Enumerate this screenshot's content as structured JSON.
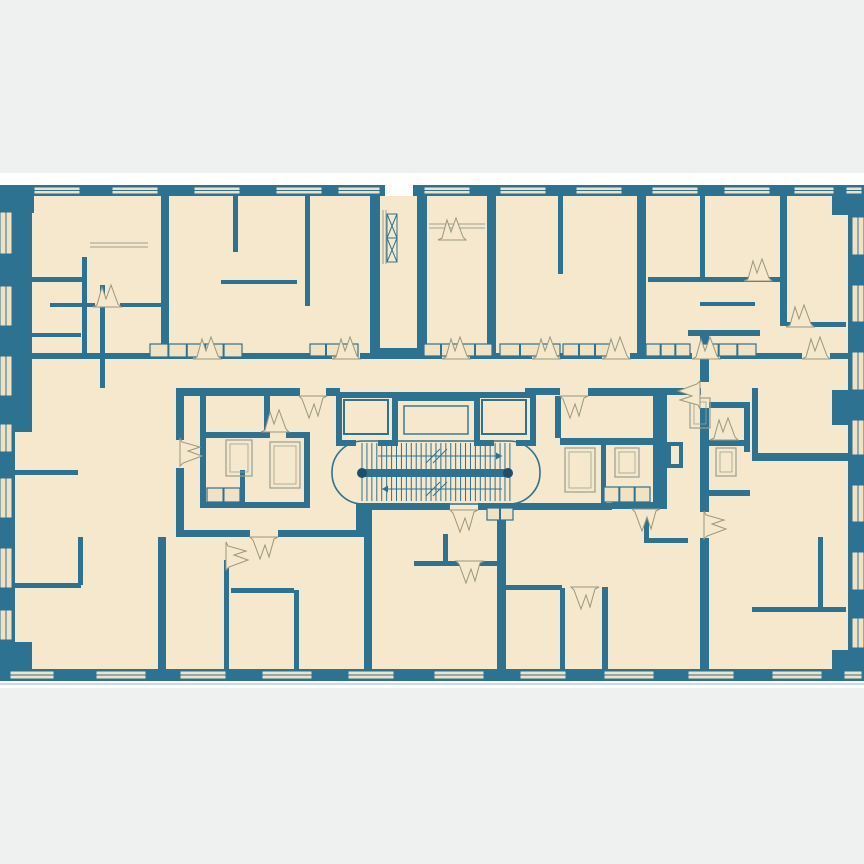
{
  "meta": {
    "title": "apartment-building-floor-plan",
    "canvas_w": 864,
    "canvas_h": 864
  },
  "palette": {
    "teal": "#2E7291",
    "teal_dark": "#1C4F6B",
    "beige": "#F6E8CC",
    "window_beige": "#F0E2C2",
    "gray_bg": "#EFF1F1",
    "white": "#FFFFFF",
    "door_stroke": "#98977F",
    "fixture_stroke": "#6E93A6",
    "furn_gray": "#9AA092",
    "light_line": "#C9DDE8"
  },
  "background": {
    "gray_top": [
      0,
      0,
      864,
      173
    ],
    "gray_bottom": [
      0,
      688,
      864,
      176
    ],
    "light_line_y": 684,
    "plan_base": [
      0,
      196,
      864,
      473
    ]
  },
  "outer_walls": [
    [
      0,
      185,
      385,
      11
    ],
    [
      413,
      185,
      451,
      11
    ],
    [
      0,
      669,
      864,
      12
    ],
    [
      0,
      185,
      15,
      496
    ],
    [
      15,
      185,
      17,
      247
    ],
    [
      0,
      185,
      34,
      28
    ],
    [
      0,
      642,
      32,
      39
    ],
    [
      848,
      185,
      16,
      496
    ],
    [
      832,
      185,
      32,
      30
    ],
    [
      832,
      390,
      16,
      35
    ],
    [
      832,
      650,
      32,
      31
    ]
  ],
  "windows_top": {
    "y": 187,
    "h": 7,
    "spans": [
      [
        34,
        46
      ],
      [
        112,
        46
      ],
      [
        194,
        46
      ],
      [
        276,
        46
      ],
      [
        338,
        42
      ],
      [
        424,
        46
      ],
      [
        500,
        46
      ],
      [
        576,
        46
      ],
      [
        652,
        46
      ],
      [
        724,
        46
      ],
      [
        794,
        40
      ],
      [
        846,
        16
      ]
    ]
  },
  "windows_bottom": {
    "y": 671,
    "h": 8,
    "spans": [
      [
        10,
        44
      ],
      [
        96,
        50
      ],
      [
        180,
        46
      ],
      [
        262,
        50
      ],
      [
        348,
        46
      ],
      [
        434,
        50
      ],
      [
        520,
        46
      ],
      [
        604,
        50
      ],
      [
        688,
        46
      ],
      [
        772,
        50
      ],
      [
        844,
        18
      ]
    ]
  },
  "windows_left": {
    "x": 0,
    "w": 12,
    "spans": [
      [
        212,
        42
      ],
      [
        286,
        40
      ],
      [
        356,
        40
      ],
      [
        424,
        28
      ],
      [
        478,
        40
      ],
      [
        548,
        40
      ],
      [
        610,
        30
      ]
    ]
  },
  "windows_right": {
    "x": 852,
    "w": 12,
    "spans": [
      [
        217,
        38
      ],
      [
        285,
        37
      ],
      [
        352,
        38
      ],
      [
        420,
        35
      ],
      [
        485,
        37
      ],
      [
        552,
        38
      ],
      [
        618,
        30
      ]
    ]
  },
  "interior_walls": [
    [
      161,
      196,
      8,
      161
    ],
    [
      233,
      196,
      5,
      56
    ],
    [
      305,
      196,
      5,
      110
    ],
    [
      370,
      196,
      10,
      158
    ],
    [
      417,
      196,
      10,
      158
    ],
    [
      487,
      196,
      9,
      160
    ],
    [
      558,
      196,
      5,
      78
    ],
    [
      637,
      196,
      9,
      160
    ],
    [
      700,
      196,
      5,
      86
    ],
    [
      780,
      196,
      7,
      130
    ],
    [
      15,
      277,
      70,
      5
    ],
    [
      15,
      333,
      66,
      4
    ],
    [
      82,
      257,
      5,
      100
    ],
    [
      100,
      285,
      5,
      103
    ],
    [
      50,
      303,
      45,
      4
    ],
    [
      120,
      303,
      45,
      4
    ],
    [
      221,
      280,
      76,
      4
    ],
    [
      648,
      277,
      132,
      5
    ],
    [
      700,
      302,
      55,
      4
    ],
    [
      787,
      322,
      59,
      5
    ],
    [
      370,
      348,
      57,
      8
    ],
    [
      15,
      353,
      178,
      6
    ],
    [
      221,
      353,
      111,
      6
    ],
    [
      360,
      353,
      82,
      6
    ],
    [
      470,
      353,
      62,
      6
    ],
    [
      560,
      353,
      42,
      6
    ],
    [
      630,
      353,
      62,
      6
    ],
    [
      720,
      353,
      82,
      6
    ],
    [
      830,
      353,
      18,
      6
    ],
    [
      176,
      388,
      124,
      8
    ],
    [
      326,
      388,
      14,
      8
    ],
    [
      525,
      388,
      35,
      7
    ],
    [
      588,
      388,
      65,
      8
    ],
    [
      653,
      388,
      48,
      7
    ],
    [
      176,
      388,
      8,
      52
    ],
    [
      176,
      468,
      8,
      69
    ],
    [
      700,
      330,
      9,
      52
    ],
    [
      700,
      408,
      9,
      104
    ],
    [
      700,
      538,
      9,
      131
    ],
    [
      176,
      530,
      74,
      7
    ],
    [
      278,
      530,
      82,
      7
    ],
    [
      356,
      503,
      8,
      34
    ],
    [
      356,
      503,
      94,
      7
    ],
    [
      478,
      503,
      134,
      7
    ],
    [
      612,
      502,
      55,
      7
    ],
    [
      653,
      390,
      14,
      117
    ],
    [
      688,
      330,
      72,
      6
    ],
    [
      667,
      442,
      16,
      4
    ],
    [
      667,
      464,
      16,
      4
    ],
    [
      667,
      442,
      4,
      26
    ],
    [
      679,
      442,
      4,
      26
    ],
    [
      752,
      388,
      6,
      65
    ],
    [
      752,
      453,
      96,
      8
    ],
    [
      200,
      388,
      6,
      120
    ],
    [
      200,
      388,
      70,
      6
    ],
    [
      264,
      388,
      6,
      50
    ],
    [
      206,
      432,
      58,
      6
    ],
    [
      286,
      432,
      24,
      6
    ],
    [
      304,
      432,
      6,
      76
    ],
    [
      240,
      470,
      5,
      32
    ],
    [
      200,
      502,
      110,
      6
    ],
    [
      560,
      438,
      107,
      7
    ],
    [
      601,
      445,
      5,
      58
    ],
    [
      555,
      396,
      6,
      42
    ],
    [
      709,
      402,
      41,
      6
    ],
    [
      744,
      402,
      6,
      50
    ],
    [
      709,
      440,
      41,
      6
    ],
    [
      709,
      490,
      41,
      6
    ],
    [
      158,
      537,
      8,
      132
    ],
    [
      224,
      560,
      5,
      109
    ],
    [
      294,
      590,
      5,
      79
    ],
    [
      231,
      588,
      63,
      5
    ],
    [
      364,
      510,
      8,
      159
    ],
    [
      497,
      510,
      9,
      159
    ],
    [
      414,
      561,
      83,
      5
    ],
    [
      443,
      534,
      5,
      29
    ],
    [
      506,
      585,
      56,
      5
    ],
    [
      560,
      588,
      5,
      81
    ],
    [
      602,
      587,
      6,
      82
    ],
    [
      644,
      507,
      5,
      36
    ],
    [
      644,
      538,
      44,
      5
    ],
    [
      818,
      537,
      5,
      74
    ],
    [
      752,
      607,
      94,
      5
    ],
    [
      15,
      470,
      63,
      5
    ],
    [
      15,
      583,
      66,
      5
    ],
    [
      78,
      537,
      5,
      48
    ]
  ],
  "elevators": [
    {
      "shaft": [
        336,
        392,
        62,
        54
      ],
      "car": [
        344,
        400,
        44,
        34
      ],
      "door_gap": [
        356,
        440,
        22
      ]
    },
    {
      "shaft": [
        474,
        392,
        62,
        54
      ],
      "car": [
        482,
        400,
        44,
        34
      ],
      "door_gap": [
        494,
        440,
        22
      ]
    }
  ],
  "machine_room": {
    "band": [
      398,
      392,
      76,
      9
    ],
    "inner": [
      404,
      406,
      64,
      28
    ]
  },
  "stair": {
    "outline": {
      "x": 332,
      "y": 441,
      "w": 208,
      "h": 63,
      "r": 31
    },
    "treads": {
      "x0": 362,
      "x1": 510,
      "step": 4.93,
      "top": [
        443,
        469
      ],
      "bottom": [
        477,
        501
      ]
    },
    "bar": {
      "rect": [
        358,
        469,
        154,
        8
      ],
      "caps": [
        [
          362,
          473
        ],
        [
          508,
          473
        ]
      ],
      "cap_r": 5
    },
    "arrows": [
      {
        "x0": 378,
        "x1": 502,
        "y": 456,
        "head": "right"
      },
      {
        "x0": 502,
        "x1": 382,
        "y": 489,
        "head": "left"
      }
    ],
    "breaks": [
      [
        [
          426,
          463
        ],
        [
          440,
          449
        ]
      ],
      [
        [
          433,
          463
        ],
        [
          447,
          449
        ]
      ],
      [
        [
          426,
          496
        ],
        [
          440,
          482
        ]
      ],
      [
        [
          433,
          496
        ],
        [
          447,
          482
        ]
      ]
    ]
  },
  "counters": [
    {
      "rect": [
        150,
        344,
        92,
        13
      ],
      "cells": 5
    },
    {
      "rect": [
        310,
        344,
        48,
        12
      ],
      "cells": 3
    },
    {
      "rect": [
        424,
        344,
        68,
        12
      ],
      "cells": 4
    },
    {
      "rect": [
        500,
        344,
        60,
        12
      ],
      "cells": 3
    },
    {
      "rect": [
        563,
        344,
        48,
        12
      ],
      "cells": 3
    },
    {
      "rect": [
        646,
        344,
        44,
        12
      ],
      "cells": 3
    },
    {
      "rect": [
        700,
        344,
        56,
        12
      ],
      "cells": 3
    },
    {
      "rect": [
        487,
        508,
        26,
        12
      ],
      "cells": 2
    },
    {
      "rect": [
        207,
        488,
        33,
        14
      ],
      "cells": 2
    },
    {
      "rect": [
        604,
        487,
        46,
        15
      ],
      "cells": 3
    }
  ],
  "fixtures": [
    [
      226,
      440,
      26,
      36
    ],
    [
      270,
      442,
      30,
      46
    ],
    [
      565,
      448,
      30,
      44
    ],
    [
      615,
      448,
      24,
      29
    ],
    [
      716,
      448,
      20,
      28
    ],
    [
      690,
      398,
      20,
      30
    ]
  ],
  "french_windows": [
    {
      "x": 429,
      "y": 224,
      "w": 56
    },
    {
      "x": 90,
      "y": 243,
      "w": 58
    }
  ],
  "shaft_ladder": {
    "rails": {
      "x1": 383,
      "x2": 386,
      "y0": 210,
      "y1": 264
    },
    "boxes": [
      [
        387,
        214,
        10,
        24
      ],
      [
        387,
        238,
        10,
        24
      ]
    ]
  },
  "door_symbol": {
    "path": "M-14 0 L-10 -2 L-5 -20 L-1 -8 L4 -22 L11 -3 L14 0 Z"
  },
  "doors": [
    {
      "x": 207,
      "y": 359,
      "r": 0
    },
    {
      "x": 346,
      "y": 359,
      "r": 0
    },
    {
      "x": 456,
      "y": 359,
      "r": 0
    },
    {
      "x": 546,
      "y": 359,
      "r": 0
    },
    {
      "x": 616,
      "y": 359,
      "r": 0
    },
    {
      "x": 706,
      "y": 359,
      "r": 0
    },
    {
      "x": 816,
      "y": 359,
      "r": 0
    },
    {
      "x": 107,
      "y": 307,
      "r": 0
    },
    {
      "x": 452,
      "y": 240,
      "r": 0
    },
    {
      "x": 758,
      "y": 281,
      "r": 0
    },
    {
      "x": 800,
      "y": 327,
      "r": 0
    },
    {
      "x": 180,
      "y": 452,
      "r": 90
    },
    {
      "x": 313,
      "y": 396,
      "r": 180
    },
    {
      "x": 574,
      "y": 396,
      "r": 180
    },
    {
      "x": 264,
      "y": 537,
      "r": 180
    },
    {
      "x": 464,
      "y": 510,
      "r": 180
    },
    {
      "x": 646,
      "y": 509,
      "r": 180
    },
    {
      "x": 275,
      "y": 432,
      "r": 0
    },
    {
      "x": 724,
      "y": 440,
      "r": 0
    },
    {
      "x": 704,
      "y": 525,
      "r": 90
    },
    {
      "x": 226,
      "y": 556,
      "r": 90
    },
    {
      "x": 470,
      "y": 561,
      "r": 180
    },
    {
      "x": 585,
      "y": 587,
      "r": 180
    },
    {
      "x": 700,
      "y": 395,
      "r": 270
    }
  ]
}
